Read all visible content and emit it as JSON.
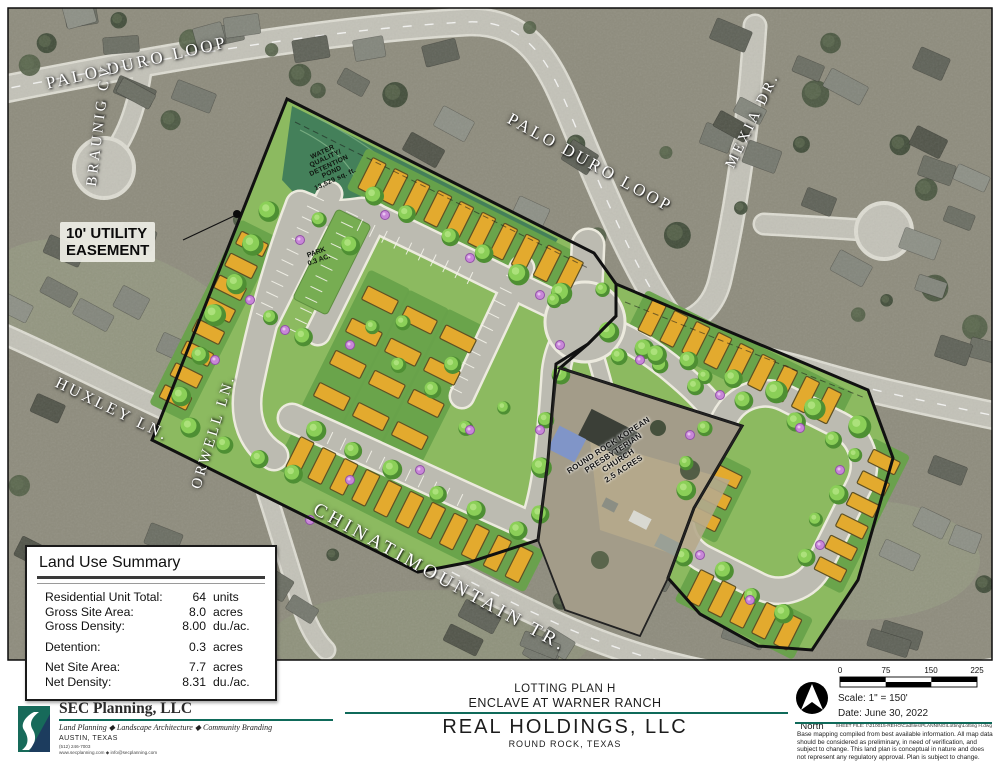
{
  "map": {
    "streets": [
      {
        "id": "palo-duro-loop-west",
        "label": "PALO DURO LOOP"
      },
      {
        "id": "braunig-cv",
        "label": "BRAUNIG CV."
      },
      {
        "id": "palo-duro-loop-east",
        "label": "PALO DURO LOOP"
      },
      {
        "id": "mexia-dr",
        "label": "MEXIA DR."
      },
      {
        "id": "huxley-ln",
        "label": "HUXLEY LN."
      },
      {
        "id": "orwell-ln",
        "label": "ORWELL LN."
      },
      {
        "id": "chinati-mountain-tr",
        "label": "CHINATIMOUNTAIN TR."
      }
    ],
    "annotations": {
      "easement": [
        "10' UTILITY",
        "EASEMENT"
      ],
      "pond": [
        "WATER",
        "QUALITY/",
        "DETENTION",
        "POND",
        "13,529 sq. ft."
      ],
      "park": [
        "PARK",
        "0.3 AC."
      ],
      "church": [
        "ROUND ROCK KOREAN",
        "PRESBYTERIAN",
        "CHURCH",
        "2.5 ACRES"
      ]
    }
  },
  "land_use_summary": {
    "title": "Land Use Summary",
    "rows": [
      {
        "label": "Residential Unit Total:",
        "value": "64",
        "unit": "units"
      },
      {
        "label": "Gross Site Area:",
        "value": "8.0",
        "unit": "acres"
      },
      {
        "label": "Gross Density:",
        "value": "8.00",
        "unit": "du./ac."
      },
      {
        "label": "Detention:",
        "value": "0.3",
        "unit": "acres"
      },
      {
        "label": "Net Site Area:",
        "value": "7.7",
        "unit": "acres"
      },
      {
        "label": "Net Density:",
        "value": "8.31",
        "unit": "du./ac."
      }
    ]
  },
  "title_block": {
    "firm": {
      "name": "SEC Planning, LLC",
      "tagline": "Land Planning ◆ Landscape Architecture ◆ Community Branding",
      "city": "AUSTIN, TEXAS",
      "phone": "(512) 246-7003",
      "web": "www.secplanning.com ◆ info@secplanning.com"
    },
    "plan_title": "LOTTING PLAN H",
    "project": "ENCLAVE AT WARNER RANCH",
    "client": "REAL HOLDINGS, LLC",
    "location": "ROUND ROCK, TEXAS",
    "north_label": "North",
    "scale_text": "Scale: 1\" = 150'",
    "date_text": "Date: June 30, 2022",
    "scale_ticks": [
      "0",
      "75",
      "150",
      "225"
    ],
    "sheet_file": "SHEET FILE: I:\\210015-REHO\\Cadfiles\\PLANNING\\Lotting\\Lotting H.dwg",
    "disclaimer": "Base mapping compiled from best available information. All map data should be considered as preliminary, in need of verification, and subject to change.  This land plan is conceptual in nature and does not represent any regulatory approval.  Plan is subject to change."
  },
  "colors": {
    "accent_teal": "#0f6a5a",
    "site_green": "#8cba60",
    "pond_green": "#44805a",
    "lot_yellow": "#e3aa2e",
    "road_gray": "#bcbbb1",
    "boundary": "#111111"
  }
}
